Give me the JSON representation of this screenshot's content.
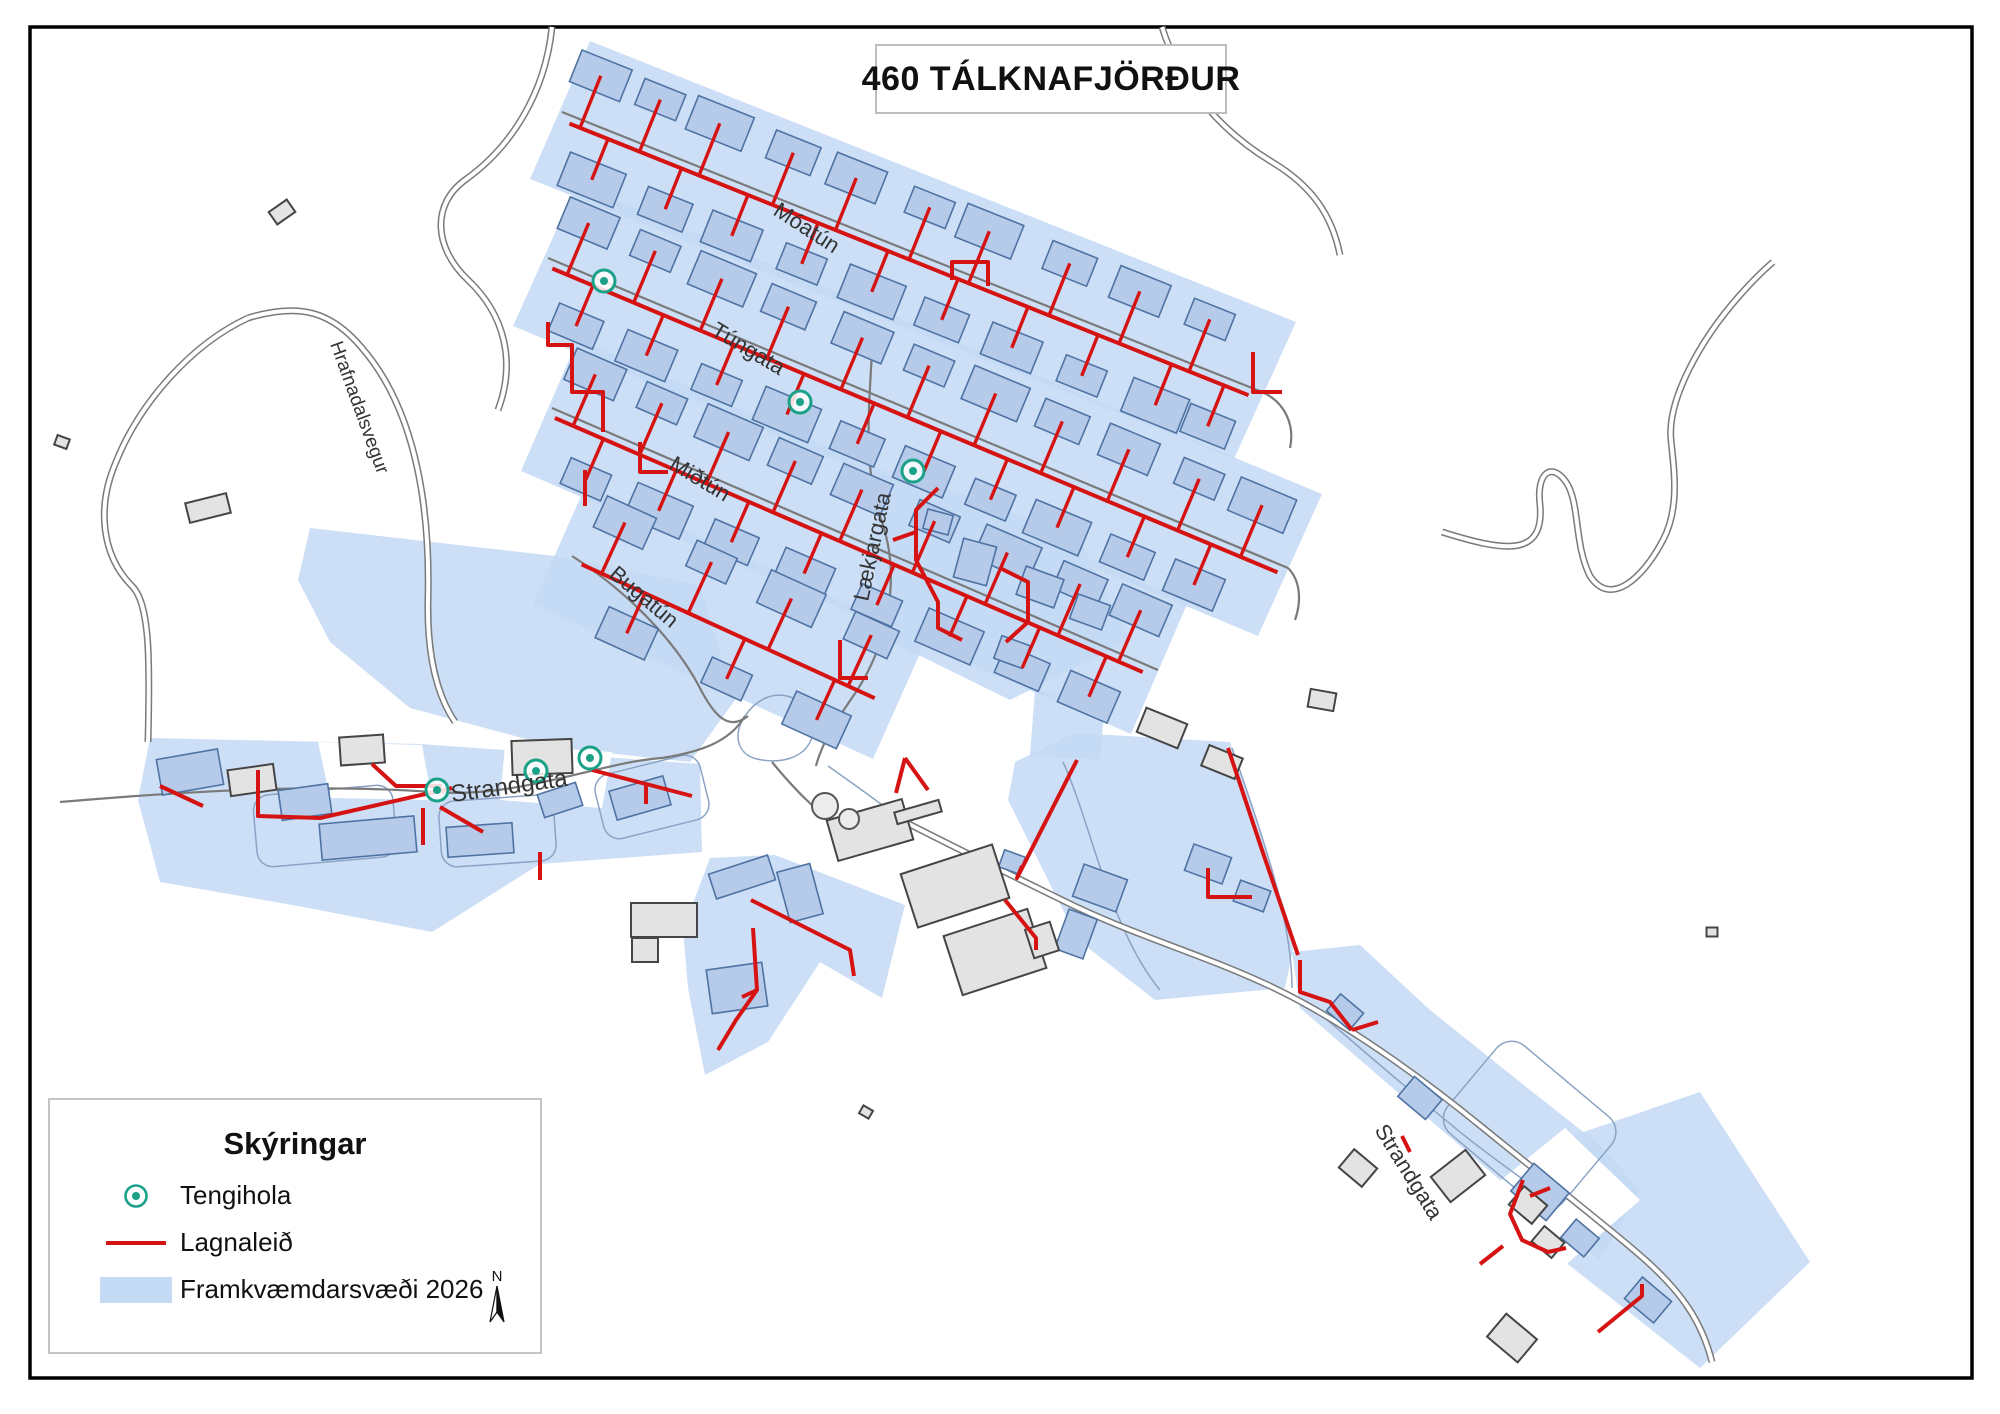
{
  "title": "460 TÁLKNAFJÖRÐUR",
  "legend": {
    "title": "Skýringar",
    "items": [
      {
        "label": "Tengihola",
        "symbol": "tengihola-point-icon",
        "color": "#1aa187"
      },
      {
        "label": "Lagnaleið",
        "symbol": "pipe-route-line",
        "color": "#d61313"
      },
      {
        "label": "Framkvæmdarsvæði 2026",
        "symbol": "work-area-swatch",
        "color": "#c3d9f4"
      }
    ],
    "north_arrow_label": "N"
  },
  "street_labels": [
    {
      "name": "Hrafnadalsvegur"
    },
    {
      "name": "Móatún"
    },
    {
      "name": "Túngata"
    },
    {
      "name": "Miðtún"
    },
    {
      "name": "Bugatún"
    },
    {
      "name": "Lækjargata"
    },
    {
      "name": "Strandgata"
    },
    {
      "name": "Strandgata"
    }
  ],
  "colors": {
    "work_area": "#c3d9f4",
    "pipe": "#d61313",
    "tengihola": "#1aa187",
    "building_in_area": "#b6cbe9",
    "building_in_area_outline": "#4e73a3",
    "building_gray": "#e3e3e3",
    "building_gray_outline": "#454545",
    "road": "#7a7a7a",
    "frame": "#000000"
  }
}
